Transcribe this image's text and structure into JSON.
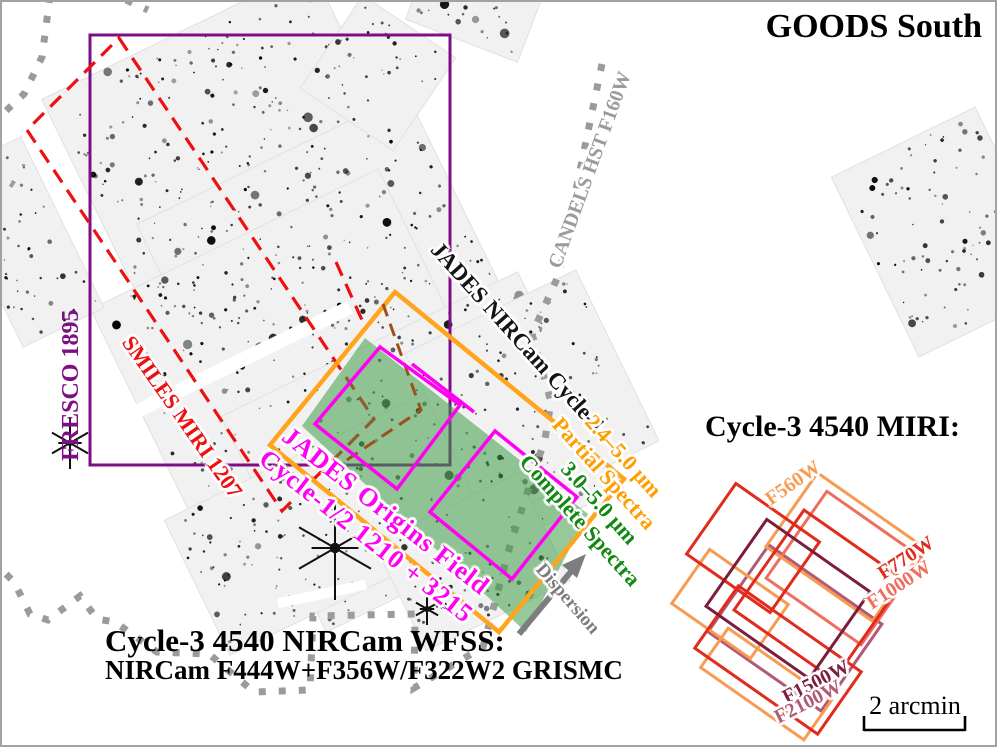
{
  "figure": {
    "title": "GOODS South",
    "field_caption_line1": "Cycle-3 4540 NIRCam WFSS:",
    "field_caption_line2": "NIRCam F444W+F356W/F322W2 GRISMC",
    "miri_title": "Cycle-3 4540 MIRI:",
    "scale_label": "2 arcmin"
  },
  "overlays": {
    "candels": {
      "label": "CANDELS HST F160W",
      "color": "#9b9b9b"
    },
    "fresco": {
      "label": "FRESCO 1895",
      "color": "#7d0f85"
    },
    "smiles": {
      "label": "SMILES MIRI 1207",
      "color": "#ee1010"
    },
    "nircam_cycle1": {
      "label": "JADES NIRCam Cycle-1",
      "color": "#141414"
    },
    "partial_spectra": {
      "range": "2.4–5.0 μm",
      "label": "Partial Spectra",
      "color": "#ff9e00"
    },
    "complete_spectra": {
      "range": "3.0–5.0 μm",
      "label": "Complete Spectra",
      "color": "#128812"
    },
    "jof": {
      "label": "JADES Origins Field",
      "sublabel": "Cycle-1/2 1210 + 3215",
      "color": "#ff00f2"
    },
    "dispersion": {
      "label": "Dispersion",
      "color": "#7d7d7d"
    },
    "wfss_outline_color": "#ffa41c",
    "grism_fill_color": "#3e9c47",
    "miri_parallel_color": "#9b511d"
  },
  "miri_filters": [
    {
      "name": "F560W",
      "color": "#f79b52"
    },
    {
      "name": "F770W",
      "color": "#e02b1d"
    },
    {
      "name": "F1000W",
      "color": "#ef6e5d"
    },
    {
      "name": "F1500W",
      "color": "#7c1d3b"
    },
    {
      "name": "F2100W",
      "color": "#b05a74"
    }
  ]
}
